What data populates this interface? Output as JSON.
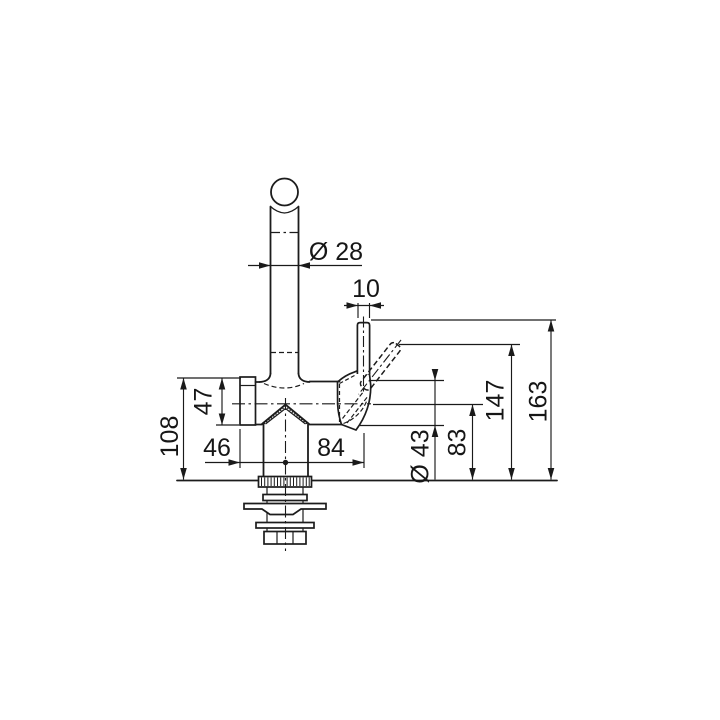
{
  "drawing": {
    "background": "#ffffff",
    "line_color": "#1c1c1c",
    "dimensions": {
      "spout_diameter": "Ø 28",
      "lever_diameter": "10",
      "end_cap_diameter": "47",
      "deck_to_body_top": "108",
      "center_to_end_cap": "46",
      "center_to_lever_axis": "84",
      "body_diameter": "Ø 43",
      "deck_to_outlet_axis": "83",
      "deck_to_tilted_lever_top": "147",
      "deck_to_upright_lever_top": "163"
    }
  }
}
